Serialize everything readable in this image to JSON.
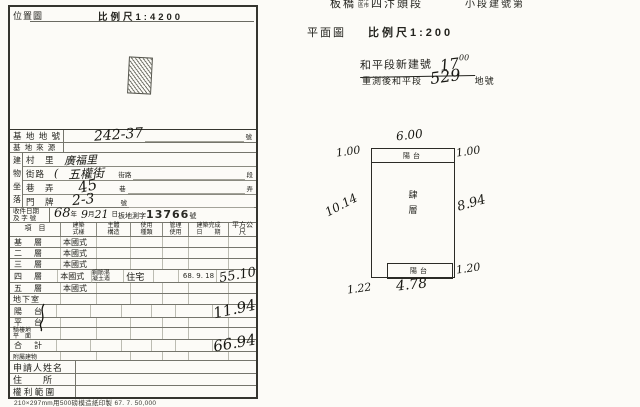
{
  "doc": {
    "print_note": "210×297mm用500磅模造紙印製 67. 7. 50,000"
  },
  "location_map": {
    "title": "位置圖",
    "scale": "比例尺1:4200"
  },
  "header": {
    "city": "板橋",
    "city_opt_top": "鎮市",
    "city_opt_bottom": "區市",
    "section": "四汴頭段",
    "subsection": "小段建號第"
  },
  "plan": {
    "title": "平面圖",
    "scale": "比例尺1:200",
    "ann_line1_label": "和平段新建號",
    "ann_line1_value": "17",
    "ann_line1_sup": "00",
    "ann_line2_label": "重測後和平段",
    "ann_line2_value": "529",
    "ann_line2_suffix": "地號",
    "balcony_top": "陽台",
    "balcony_bottom": "陽台",
    "floor_label": "肆\n層",
    "dim_top": "6.00",
    "dim_top_left": "1.00",
    "dim_top_right": "1.00",
    "dim_left": "10.14",
    "dim_right": "8.94",
    "dim_balcony_right": "1.20",
    "dim_bottom_left": "1.22",
    "dim_bottom": "4.78"
  },
  "table": {
    "site_no_label": "基 地 地 號",
    "site_no_value": "242-37",
    "site_no_suffix": "號",
    "site_src_label": "基 地 來 源",
    "loc_col": "建\n物\n坐\n落",
    "village_label": "村　里",
    "village_value": "廣福里",
    "street_label": "街路",
    "street_brace": "(",
    "street_value": "五權街",
    "street_printed": "街路",
    "street_suffix": "段",
    "lane_label": "巷　弄",
    "lane_value": "45",
    "lane_printed": "巷",
    "lane_suffix": "弄",
    "door_label": "門　牌",
    "door_value": "2-3",
    "door_printed": "號",
    "receipt_label": "收件日期\n及 字 號",
    "receipt_year": "68",
    "receipt_year_unit": "年",
    "receipt_month": "9",
    "receipt_month_unit": "月",
    "receipt_day": "21",
    "receipt_day_unit": "日",
    "receipt_doc": "板地測字",
    "receipt_no": "13766",
    "receipt_suffix": "號",
    "col_item": "項　目",
    "col_style": "建築\n式樣",
    "col_structure": "主體\n構造",
    "col_usage": "使用\n種類",
    "col_mgmt": "管理\n使用",
    "col_completed": "建築完成\n日　　期",
    "col_area": "平方公尺",
    "floors": [
      {
        "name": "基　層",
        "style": "本國式"
      },
      {
        "name": "二　層",
        "style": "本國式"
      },
      {
        "name": "三　層",
        "style": "本國式"
      },
      {
        "name": "四　層",
        "style": "本國式",
        "structure": "鋼筋混\n凝土造",
        "usage": "住宅",
        "completed": "68. 9. 18",
        "area": "55.10"
      },
      {
        "name": "五　層",
        "style": "本國式"
      },
      {
        "name": "地下室",
        "style": ""
      }
    ],
    "balcony_label": "陽　台",
    "balcony_area": "11.94",
    "platform_label": "平　台",
    "arcade_label": "騎樓地\n平　面",
    "total_label": "合　計",
    "total_area": "66.94",
    "annex_label": "附屬建物",
    "applicant_label": "申請人姓名",
    "address_label": "住　　所",
    "rights_label": "權 利 範 圍"
  }
}
